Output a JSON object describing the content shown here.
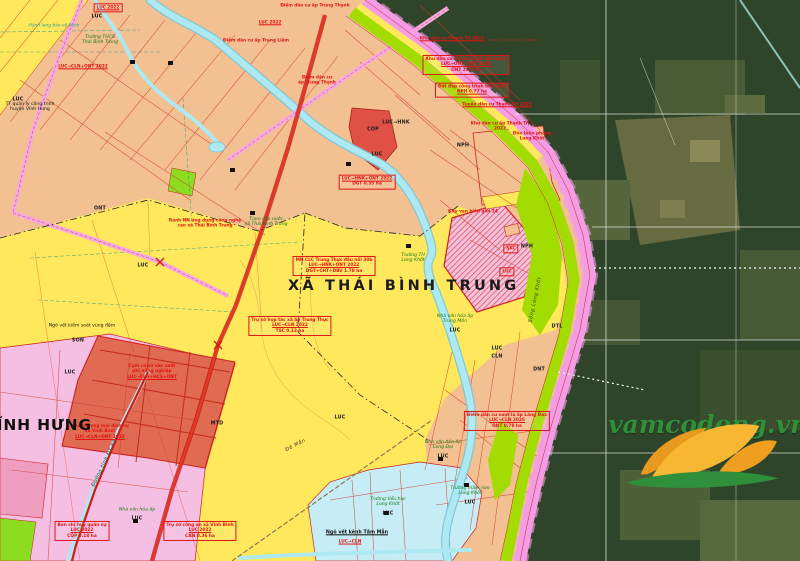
{
  "palette": {
    "luc_yellow": "#ffe85c",
    "ont_salmon": "#f2c091",
    "pink_zone": "#f4bfe2",
    "border_pink": "#f49ce4",
    "green_strip": "#a2dc00",
    "red_zone": "#e06a52",
    "cop_red": "#e05044",
    "river_blue": "#ace9f2",
    "blue_zone": "#c6edf5",
    "road_red": "#d81a10",
    "anno_red": "#e01414",
    "sat_green": "#2f4529",
    "logo_orange": "#f7b733",
    "logo_green": "#2f8f3a",
    "text_green": "#157a15"
  },
  "map": {
    "commune_label": "XÃ THÁI BÌNH TRUNG",
    "neighbor_label": "VĨNH HƯNG",
    "labels": [
      {
        "t": "LUC",
        "x": 97,
        "y": 17
      },
      {
        "t": "LUC",
        "x": 18,
        "y": 100
      },
      {
        "t": "LUC",
        "x": 143,
        "y": 266
      },
      {
        "t": "LUC",
        "x": 70,
        "y": 373
      },
      {
        "t": "LUC",
        "x": 340,
        "y": 418
      },
      {
        "t": "LUC",
        "x": 377,
        "y": 155
      },
      {
        "t": "LUC→HNK",
        "x": 396,
        "y": 123
      },
      {
        "t": "LUC",
        "x": 497,
        "y": 349
      },
      {
        "t": "CLN",
        "x": 497,
        "y": 357
      },
      {
        "t": "ONT",
        "x": 100,
        "y": 209
      },
      {
        "t": "MTD",
        "x": 217,
        "y": 424
      },
      {
        "t": "SON",
        "x": 78,
        "y": 341
      },
      {
        "t": "NPH",
        "x": 527,
        "y": 247
      },
      {
        "t": "NPH",
        "x": 463,
        "y": 146
      },
      {
        "t": "DTL",
        "x": 557,
        "y": 327
      },
      {
        "t": "COP",
        "x": 373,
        "y": 130
      },
      {
        "t": "DNT",
        "x": 539,
        "y": 370
      },
      {
        "t": "Trường TH\nLong Khốt",
        "x": 413,
        "y": 258,
        "k": "green"
      },
      {
        "t": "Trường tiểu học\nLong Khốt",
        "x": 388,
        "y": 502,
        "k": "green"
      },
      {
        "t": "LUC",
        "x": 388,
        "y": 514
      },
      {
        "t": "Trường mầm non\nLong Khốt",
        "x": 470,
        "y": 491,
        "k": "green"
      },
      {
        "t": "LUC",
        "x": 470,
        "y": 503
      },
      {
        "t": "Nhà văn hóa ấp\nLong Đại",
        "x": 443,
        "y": 445,
        "k": "green"
      },
      {
        "t": "LUC",
        "x": 443,
        "y": 457
      },
      {
        "t": "Nhà văn hóa ấp\nTrung Môn",
        "x": 455,
        "y": 319,
        "k": "green"
      },
      {
        "t": "LUC",
        "x": 455,
        "y": 331
      },
      {
        "t": "Nhà văn hóa ấp",
        "x": 137,
        "y": 510,
        "k": "green"
      },
      {
        "t": "LUC",
        "x": 137,
        "y": 519
      },
      {
        "t": "Trạm cấp nước\nxã Thái Bình Trung",
        "x": 266,
        "y": 222,
        "k": "green"
      },
      {
        "t": "Trường THCS\nThái Bình Trung",
        "x": 100,
        "y": 40,
        "k": "green"
      },
      {
        "t": "Hành lang bảo vệ kênh",
        "x": 54,
        "y": 27,
        "k": "teal"
      },
      {
        "t": "TT quản lý công trình\nhuyện Vĩnh Hưng",
        "x": 30,
        "y": 107,
        "k": "black"
      },
      {
        "t": "Ngõ vết kiểm soát vùng đệm",
        "x": 82,
        "y": 326,
        "k": "black"
      },
      {
        "t": "Ngõ vết kênh Tầm Mẫn",
        "x": 357,
        "y": 533,
        "k": "black-u"
      },
      {
        "t": "LUC→CLN",
        "x": 350,
        "y": 543,
        "k": "red"
      },
      {
        "t": "Đê Mẫn",
        "x": 296,
        "y": 446,
        "k": "road",
        "rot": -27
      },
      {
        "t": "Đường tỉnh ĐT.831",
        "x": 106,
        "y": 462,
        "k": "road",
        "rot": -64
      },
      {
        "t": "Sông Long Khốt",
        "x": 536,
        "y": 300,
        "k": "road",
        "rot": -78
      }
    ]
  },
  "annotations": [
    {
      "x": 108,
      "y": 8,
      "box": true,
      "lines": [
        "LUC 2022"
      ],
      "u": [
        0
      ]
    },
    {
      "x": 83,
      "y": 67,
      "lines": [
        "LUC→CLN+ONT 2022"
      ],
      "u": [
        0
      ]
    },
    {
      "x": 334,
      "y": 266,
      "box": true,
      "lines": [
        "MN CLC Trung Thực đấu nối 30b",
        "LUC→HNK+ONT 2022",
        "DGT+CHT+DBV 1.78 ha"
      ],
      "u": [
        1
      ]
    },
    {
      "x": 290,
      "y": 326,
      "box": true,
      "lines": [
        "Trụ sở hợp tác xã ấp Trung Thực",
        "LUC→CLN 2022",
        "TSC 0.13 ha"
      ],
      "u": [
        1
      ]
    },
    {
      "x": 367,
      "y": 182,
      "box": true,
      "lines": [
        "LUC→HNK+ONT 2022",
        "DGT 0.35 ha"
      ],
      "u": [
        0
      ]
    },
    {
      "x": 511,
      "y": 249,
      "box": true,
      "lines": [
        "SKC"
      ]
    },
    {
      "x": 507,
      "y": 272,
      "box": true,
      "lines": [
        "LUC"
      ]
    },
    {
      "x": 82,
      "y": 531,
      "box": true,
      "lines": [
        "Ban chỉ huy quân sự",
        "LUC 2022",
        "CQP 0.18 ha"
      ],
      "u": [
        1
      ]
    },
    {
      "x": 200,
      "y": 531,
      "box": true,
      "lines": [
        "Trụ sở công an xã Vĩnh Bình",
        "LUC 2022",
        "CAN 0.36 ha"
      ],
      "u": [
        1
      ]
    },
    {
      "x": 507,
      "y": 421,
      "box": true,
      "lines": [
        "Điểm dân cư vượt lũ ấp Láng Đao",
        "LUC→CLN 2026",
        "ONT 0.78 ha"
      ],
      "u": [
        1
      ]
    },
    {
      "x": 100,
      "y": 432,
      "lines": [
        "Khu thương mại dịch vụ",
        "xã Vĩnh Bình",
        "LUC→CLN+ONT 2022"
      ],
      "u": [
        2
      ]
    },
    {
      "x": 152,
      "y": 372,
      "lines": [
        "Cụm cơ sở sản xuất",
        "phi nông nghiệp",
        "LUC→CLN+HCS+ONT"
      ],
      "u": [
        2
      ]
    },
    {
      "x": 205,
      "y": 224,
      "lines": [
        "Ranh NN ứng dụng công nghệ",
        "cao xã Thái Bình Trung"
      ]
    },
    {
      "x": 270,
      "y": 23,
      "lines": [
        "LUC 2022"
      ],
      "u": [
        0
      ]
    },
    {
      "x": 315,
      "y": 6,
      "lines": [
        "Điểm dân cư ấp Trung Thạnh"
      ]
    },
    {
      "x": 317,
      "y": 81,
      "lines": [
        "Điểm dân cư",
        "ấp Trung Thạnh"
      ]
    },
    {
      "x": 256,
      "y": 41,
      "lines": [
        "Điểm dân cư ấp Trung Liêm"
      ]
    },
    {
      "x": 473,
      "y": 212,
      "lines": [
        "Khu ven biên giới 24"
      ]
    },
    {
      "x": 532,
      "y": 137,
      "lines": [
        "Đồn biên phòng",
        "Long Khốt"
      ]
    },
    {
      "x": 452,
      "y": 39,
      "lines": [
        "Khu dân cư Thạnh Trị 2022"
      ],
      "u": [
        0
      ]
    },
    {
      "x": 466,
      "y": 65,
      "box": true,
      "lines": [
        "Khu dân cư liền kề chốt dân quân",
        "LUC→ONT+DGT 2030",
        "ONT 2.53 ha"
      ],
      "u": [
        1
      ]
    },
    {
      "x": 472,
      "y": 90,
      "box": true,
      "lines": [
        "Đất đắp công trình biên giới",
        "NPH 0.77 ha"
      ],
      "u": [
        1
      ]
    },
    {
      "x": 497,
      "y": 105,
      "lines": [
        "Tuyến dân cư Thạnh Trị 2022"
      ],
      "u": [
        0
      ]
    },
    {
      "x": 500,
      "y": 127,
      "lines": [
        "Khu dân cư ấp Thạnh Trị",
        "2022"
      ]
    }
  ],
  "logo": {
    "text": "vamcodong.vn"
  }
}
